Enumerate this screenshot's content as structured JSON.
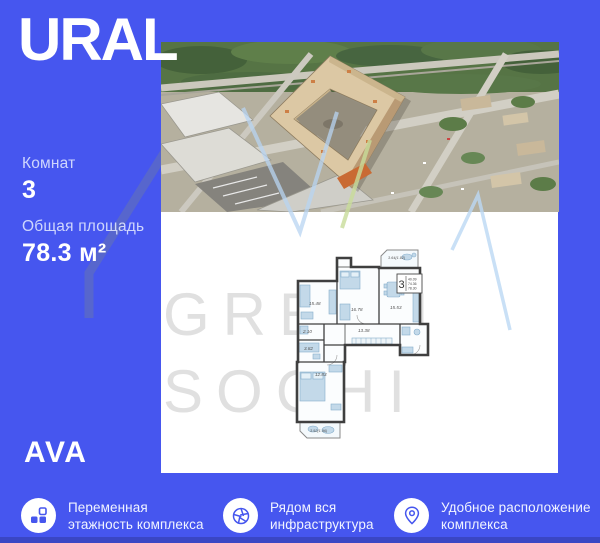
{
  "brand": {
    "logo": "URAL",
    "developer": "AVA"
  },
  "listing": {
    "rooms_label": "Комнат",
    "rooms_value": "3",
    "area_label": "Общая площадь",
    "area_value": "78.3 м²"
  },
  "watermark": {
    "line1": "GREEN",
    "line2": "SOCHI"
  },
  "floorplan": {
    "stamp": {
      "rooms_value": "3",
      "area_rows": [
        "40.09",
        "74.36",
        "78.30"
      ]
    },
    "rooms": [
      {
        "id": "balcony-top",
        "label": "3.64(1.82)"
      },
      {
        "id": "living-1",
        "label": "15.48"
      },
      {
        "id": "living-2",
        "label": "16.78"
      },
      {
        "id": "kitchen-living",
        "label": "15.53"
      },
      {
        "id": "corridor",
        "label": "13.38"
      },
      {
        "id": "wc",
        "label": "2.10"
      },
      {
        "id": "bathroom",
        "label": "3.82"
      },
      {
        "id": "bedroom",
        "label": "12.83"
      },
      {
        "id": "balcony-bottom",
        "label": "3.92(1.96)"
      }
    ]
  },
  "features": [
    {
      "icon": "blocks-icon",
      "lines": [
        "Переменная",
        "этажность комплекса"
      ]
    },
    {
      "icon": "aperture-icon",
      "lines": [
        "Рядом вся",
        "инфраструктура"
      ]
    },
    {
      "icon": "location-pin-icon",
      "lines": [
        "Удобное расположение",
        "комплекса"
      ]
    }
  ],
  "colors": {
    "background": "#4656EF",
    "bottom_strip": "#3A46C4",
    "icon_accent": "#4656EE",
    "watermark": "#E0E0E0",
    "text": "#FFFFFF"
  }
}
